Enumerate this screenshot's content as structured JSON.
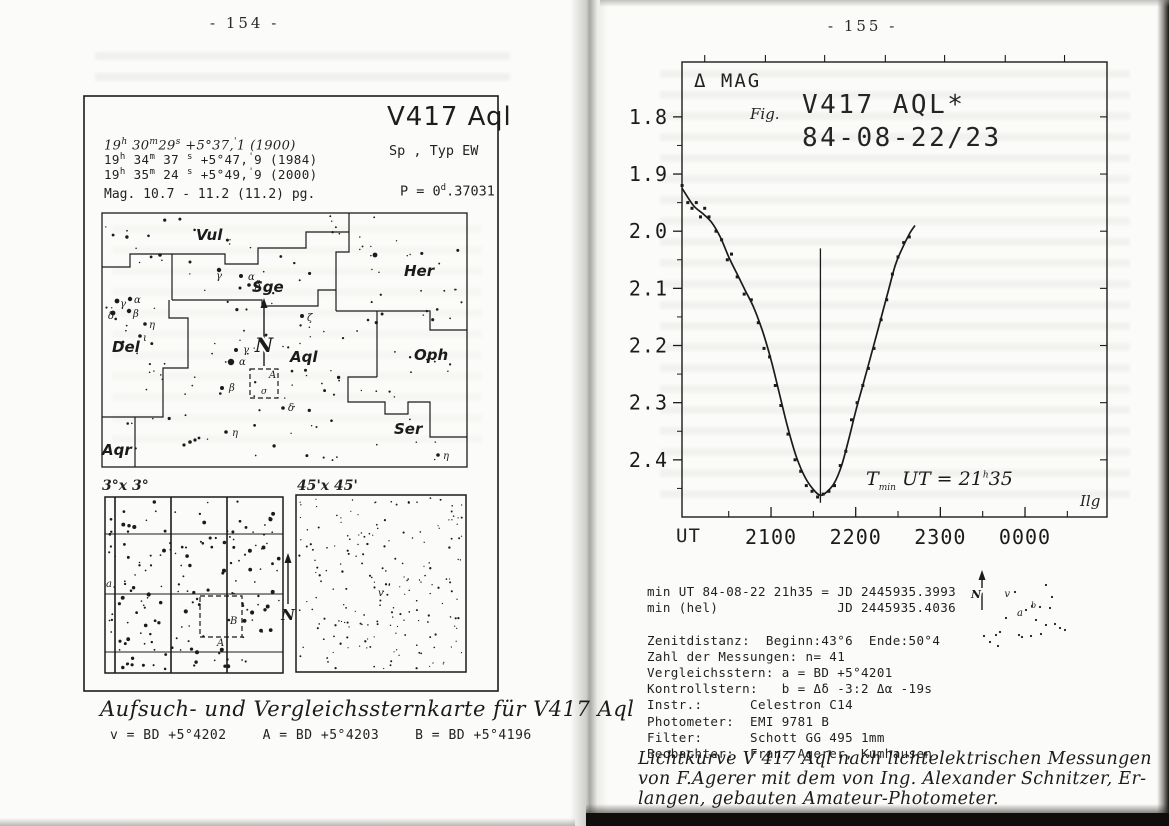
{
  "scan": {
    "left_page_number": "-  154  -",
    "right_page_number": "-  155  -"
  },
  "left_figure": {
    "title": "V417 Aql",
    "sp_typ_line": "Sp      , Typ EW",
    "coord_lines": [
      {
        "style": "hand",
        "segments": [
          [
            "n",
            "19"
          ],
          [
            "s",
            "h"
          ],
          [
            "n",
            " 30"
          ],
          [
            "s",
            "m"
          ],
          [
            "n",
            "29"
          ],
          [
            "s",
            "s"
          ],
          [
            "n",
            "   +5°37,"
          ],
          [
            "s",
            "'"
          ],
          [
            "n",
            "1 (1900)"
          ]
        ]
      },
      {
        "style": "typed",
        "segments": [
          [
            "n",
            "19"
          ],
          [
            "s",
            "h"
          ],
          [
            "n",
            " 34"
          ],
          [
            "s",
            "m"
          ],
          [
            "n",
            " 37 "
          ],
          [
            "s",
            "s"
          ],
          [
            "n",
            "  +5°47,"
          ],
          [
            "s",
            "'"
          ],
          [
            "n",
            "9 (1984)"
          ]
        ]
      },
      {
        "style": "typed",
        "segments": [
          [
            "n",
            "19"
          ],
          [
            "s",
            "h"
          ],
          [
            "n",
            " 35"
          ],
          [
            "s",
            "m"
          ],
          [
            "n",
            " 24 "
          ],
          [
            "s",
            "s"
          ],
          [
            "n",
            "  +5°49,"
          ],
          [
            "s",
            "'"
          ],
          [
            "n",
            "9 (2000)"
          ]
        ]
      }
    ],
    "mag_line": "Mag. 10.7 - 11.2 (11.2) pg.",
    "period_segments": [
      [
        "n",
        "P = 0"
      ],
      [
        "s",
        "d"
      ],
      [
        "n",
        ".37031"
      ]
    ],
    "north_label": "N",
    "constellation_labels": [
      {
        "name": "Vul",
        "x": 196,
        "y": 240
      },
      {
        "name": "Sge",
        "x": 252,
        "y": 292
      },
      {
        "name": "Her",
        "x": 404,
        "y": 276
      },
      {
        "name": "Del",
        "x": 112,
        "y": 352
      },
      {
        "name": "Aql",
        "x": 290,
        "y": 362
      },
      {
        "name": "Oph",
        "x": 414,
        "y": 360
      },
      {
        "name": "Ser",
        "x": 394,
        "y": 434
      },
      {
        "name": "Aqr",
        "x": 102,
        "y": 455
      }
    ],
    "greek_labels": [
      {
        "t": "γ",
        "x": 216,
        "y": 279
      },
      {
        "t": "α",
        "x": 248,
        "y": 280
      },
      {
        "t": "β",
        "x": 255,
        "y": 288
      },
      {
        "t": "γ",
        "x": 120,
        "y": 307
      },
      {
        "t": "α",
        "x": 134,
        "y": 303
      },
      {
        "t": "δ",
        "x": 108,
        "y": 319
      },
      {
        "t": "β",
        "x": 133,
        "y": 317
      },
      {
        "t": "η",
        "x": 149,
        "y": 328
      },
      {
        "t": "ι",
        "x": 143,
        "y": 341
      },
      {
        "t": "γ",
        "x": 243,
        "y": 353
      },
      {
        "t": "α",
        "x": 239,
        "y": 365
      },
      {
        "t": "β",
        "x": 229,
        "y": 391
      },
      {
        "t": "δ",
        "x": 288,
        "y": 411
      },
      {
        "t": "η",
        "x": 232,
        "y": 436
      },
      {
        "t": "ζ",
        "x": 307,
        "y": 321
      },
      {
        "t": "η",
        "x": 443,
        "y": 459
      }
    ],
    "dashed_box_label": "A",
    "dashed_box_sigma": "σ",
    "inset_left_label": "3°x 3°",
    "inset_right_label": "45'x 45'",
    "inset_marks": {
      "a": "a",
      "A": "A",
      "B": "B",
      "v": "v"
    },
    "caption": "Aufsuch- und Vergleichssternkarte für V417 Aql",
    "comparison_stars": [
      "v = BD +5°4202",
      "A = BD +5°4203",
      "B = BD +5°4196"
    ]
  },
  "chart_data": {
    "type": "scatter",
    "fig_label": "Fig.",
    "title": "V417 AQL*",
    "subtitle": "84-08-22/23",
    "ylabel": "Δ MAG",
    "xlabel": "UT",
    "corner_label": "Ilg",
    "y_axis_direction": "inverted (fainter magnitude downward)",
    "x_tick_labels": [
      "2100",
      "2200",
      "2300",
      "0000"
    ],
    "x_tick_minutes_after_2000": [
      60,
      120,
      180,
      240
    ],
    "x_minor_minutes_after_2000": [
      30,
      90,
      150,
      210,
      270
    ],
    "top_tick_minutes_after_2000": [
      13,
      56,
      98,
      141,
      183,
      226,
      268
    ],
    "y_tick_labels": [
      "1.8",
      "1.9",
      "2.0",
      "2.1",
      "2.2",
      "2.3",
      "2.4"
    ],
    "y_tick_values": [
      1.8,
      1.9,
      2.0,
      2.1,
      2.2,
      2.3,
      2.4
    ],
    "y_minor_values": [
      1.85,
      1.95,
      2.05,
      2.15,
      2.25,
      2.35,
      2.45
    ],
    "xlim_minutes_after_2000": [
      -3.1,
      298.1
    ],
    "ylim_mag": [
      1.704,
      2.5
    ],
    "points_ut_mag": [
      [
        "1957",
        1.92
      ],
      [
        "2001",
        1.95
      ],
      [
        "2004",
        1.96
      ],
      [
        "2007",
        1.95
      ],
      [
        "2010",
        1.975
      ],
      [
        "2013",
        1.96
      ],
      [
        "2016",
        1.975
      ],
      [
        "2021",
        2.0
      ],
      [
        "2025",
        2.015
      ],
      [
        "2029",
        2.05
      ],
      [
        "2032",
        2.04
      ],
      [
        "2036",
        2.08
      ],
      [
        "2041",
        2.11
      ],
      [
        "2046",
        2.12
      ],
      [
        "2051",
        2.16
      ],
      [
        "2055",
        2.205
      ],
      [
        "2059",
        2.22
      ],
      [
        "2103",
        2.27
      ],
      [
        "2107",
        2.305
      ],
      [
        "2112",
        2.355
      ],
      [
        "2117",
        2.4
      ],
      [
        "2121",
        2.42
      ],
      [
        "2125",
        2.445
      ],
      [
        "2129",
        2.455
      ],
      [
        "2133",
        2.465
      ],
      [
        "2137",
        2.46
      ],
      [
        "2141",
        2.455
      ],
      [
        "2145",
        2.445
      ],
      [
        "2149",
        2.41
      ],
      [
        "2153",
        2.385
      ],
      [
        "2157",
        2.33
      ],
      [
        "2201",
        2.3
      ],
      [
        "2205",
        2.27
      ],
      [
        "2209",
        2.24
      ],
      [
        "2213",
        2.205
      ],
      [
        "2218",
        2.155
      ],
      [
        "2222",
        2.12
      ],
      [
        "2226",
        2.075
      ],
      [
        "2230",
        2.045
      ],
      [
        "2234",
        2.02
      ],
      [
        "2238",
        2.01
      ]
    ],
    "fit_curve_ut_mag": [
      [
        "1957",
        1.925
      ],
      [
        "2005",
        1.955
      ],
      [
        "2012",
        1.97
      ],
      [
        "2018",
        1.985
      ],
      [
        "2024",
        2.01
      ],
      [
        "2030",
        2.045
      ],
      [
        "2036",
        2.075
      ],
      [
        "2042",
        2.105
      ],
      [
        "2048",
        2.135
      ],
      [
        "2054",
        2.175
      ],
      [
        "2100",
        2.225
      ],
      [
        "2106",
        2.285
      ],
      [
        "2112",
        2.345
      ],
      [
        "2118",
        2.395
      ],
      [
        "2124",
        2.43
      ],
      [
        "2130",
        2.452
      ],
      [
        "2135",
        2.462
      ],
      [
        "2140",
        2.455
      ],
      [
        "2145",
        2.44
      ],
      [
        "2150",
        2.41
      ],
      [
        "2155",
        2.365
      ],
      [
        "2200",
        2.315
      ],
      [
        "2205",
        2.27
      ],
      [
        "2210",
        2.225
      ],
      [
        "2216",
        2.17
      ],
      [
        "2222",
        2.115
      ],
      [
        "2228",
        2.06
      ],
      [
        "2233",
        2.03
      ],
      [
        "2238",
        2.005
      ],
      [
        "2242",
        1.99
      ]
    ],
    "minimum": {
      "ut": "2135",
      "line_top_mag": 2.03,
      "line_bottom_mag": 2.475,
      "annotation_segments": [
        [
          "n",
          "T"
        ],
        [
          "b",
          "min"
        ],
        [
          "n",
          " UT = 21"
        ],
        [
          "s",
          "h"
        ],
        [
          "n",
          "35"
        ]
      ]
    }
  },
  "right_info": {
    "lines": [
      "min UT 84-08-22 21h35 = JD 2445935.3993",
      "min (hel)               JD 2445935.4036",
      "",
      "Zenitdistanz:  Beginn:43°6  Ende:50°4",
      "Zahl der Messungen: n= 41",
      "Vergleichsstern: a = BD +5°4201",
      "Kontrollstern:   b = Δδ -3:2 Δα -19s",
      "Instr.:      Celestron C14",
      "Photometer:  EMI 9781 B",
      "Filter:      Schott GG 495 1mm",
      "Beobachter:  Franz Agerer, Kumhausen"
    ],
    "mini_chart": {
      "north_label": "N",
      "labels": {
        "v": "v",
        "a": "a",
        "b": "b"
      },
      "dots": [
        [
          1046,
          585
        ],
        [
          1015,
          592
        ],
        [
          1026,
          610
        ],
        [
          1032,
          606
        ],
        [
          1040,
          607
        ],
        [
          1050,
          608
        ],
        [
          1006,
          618
        ],
        [
          1000,
          632
        ],
        [
          1046,
          625
        ],
        [
          1055,
          624
        ],
        [
          1031,
          636
        ],
        [
          1022,
          637
        ],
        [
          996,
          635
        ],
        [
          984,
          636
        ],
        [
          990,
          642
        ],
        [
          998,
          646
        ],
        [
          1019,
          635
        ],
        [
          1041,
          634
        ],
        [
          1060,
          628
        ],
        [
          1065,
          630
        ],
        [
          1052,
          597
        ],
        [
          1036,
          620
        ]
      ]
    }
  },
  "right_caption_lines": [
    "Lichtkurve V 417 Aql nach lichtelektrischen Messungen",
    "von F.Agerer mit dem von Ing. Alexander Schnitzer, Er-",
    "langen, gebauten Amateur-Photometer."
  ],
  "geometry": {
    "outer_box": [
      84,
      96,
      414,
      595
    ],
    "main_chart_box": [
      102,
      213,
      365,
      254
    ],
    "boundaries": [
      [
        [
          102,
          267
        ],
        [
          130,
          267
        ],
        [
          130,
          254
        ],
        [
          172,
          254
        ]
      ],
      [
        [
          172,
          254
        ],
        [
          172,
          300
        ]
      ],
      [
        [
          172,
          254
        ],
        [
          225,
          254
        ],
        [
          225,
          264
        ],
        [
          258,
          264
        ],
        [
          258,
          248
        ],
        [
          306,
          248
        ],
        [
          306,
          232
        ],
        [
          349,
          232
        ]
      ],
      [
        [
          349,
          213
        ],
        [
          349,
          252
        ],
        [
          336,
          252
        ],
        [
          336,
          311
        ]
      ],
      [
        [
          172,
          300
        ],
        [
          262,
          300
        ],
        [
          262,
          306
        ],
        [
          318,
          306
        ],
        [
          318,
          290
        ],
        [
          336,
          290
        ]
      ],
      [
        [
          336,
          311
        ],
        [
          430,
          311
        ],
        [
          430,
          330
        ],
        [
          467,
          330
        ]
      ],
      [
        [
          377,
          311
        ],
        [
          377,
          377
        ]
      ],
      [
        [
          377,
          377
        ],
        [
          348,
          377
        ],
        [
          348,
          402
        ],
        [
          385,
          402
        ],
        [
          385,
          414
        ],
        [
          408,
          414
        ],
        [
          408,
          402
        ],
        [
          430,
          402
        ],
        [
          430,
          437
        ],
        [
          467,
          437
        ]
      ],
      [
        [
          169,
          300
        ],
        [
          169,
          318
        ],
        [
          188,
          318
        ],
        [
          188,
          368
        ],
        [
          163,
          368
        ],
        [
          163,
          417
        ],
        [
          102,
          417
        ]
      ],
      [
        [
          135,
          417
        ],
        [
          135,
          467
        ]
      ]
    ],
    "dashed_box": [
      250,
      369,
      28,
      29
    ],
    "feature_stars": [
      [
        219,
        270,
        2.2
      ],
      [
        375,
        255,
        2.4
      ],
      [
        160,
        255,
        1.8
      ],
      [
        190,
        262,
        1.5
      ],
      [
        241,
        276,
        2.0
      ],
      [
        249,
        285,
        1.8
      ],
      [
        240,
        288,
        1.5
      ],
      [
        117,
        301,
        2.4
      ],
      [
        130,
        299,
        2.2
      ],
      [
        113,
        313,
        2.4
      ],
      [
        129,
        311,
        2.2
      ],
      [
        145,
        324,
        1.8
      ],
      [
        140,
        336,
        1.8
      ],
      [
        123,
        342,
        1.4
      ],
      [
        236,
        350,
        2.0
      ],
      [
        231,
        362,
        3.2
      ],
      [
        222,
        388,
        2.0
      ],
      [
        283,
        408,
        1.8
      ],
      [
        226,
        432,
        1.8
      ],
      [
        302,
        316,
        2.0
      ],
      [
        438,
        455,
        1.8
      ],
      [
        184,
        445,
        1.6
      ],
      [
        190,
        442,
        1.8
      ],
      [
        195,
        440,
        1.6
      ],
      [
        199,
        438,
        1.4
      ]
    ],
    "star_fields": [
      {
        "name": "main-field",
        "x": 104,
        "y": 216,
        "w": 360,
        "h": 248,
        "count": 150,
        "seed": 11,
        "rmin": 0.7,
        "rmax": 1.7
      },
      {
        "name": "inset-3deg-field",
        "x": 108,
        "y": 500,
        "w": 172,
        "h": 170,
        "count": 165,
        "seed": 23,
        "rmin": 0.8,
        "rmax": 2.1
      },
      {
        "name": "inset-45arcmin-field",
        "x": 299,
        "y": 498,
        "w": 164,
        "h": 171,
        "count": 195,
        "seed": 37,
        "rmin": 0.6,
        "rmax": 1.2
      }
    ],
    "inset_left_box": [
      105,
      497,
      178,
      176
    ],
    "inset_left_vlines": [
      115,
      171,
      227
    ],
    "inset_left_hlines": [
      534,
      594,
      652
    ],
    "inset_left_dashed": [
      200,
      596,
      42,
      41
    ],
    "inset_right_box": [
      296,
      495,
      170,
      177
    ],
    "chart_frame": [
      682,
      62,
      425,
      455
    ]
  }
}
